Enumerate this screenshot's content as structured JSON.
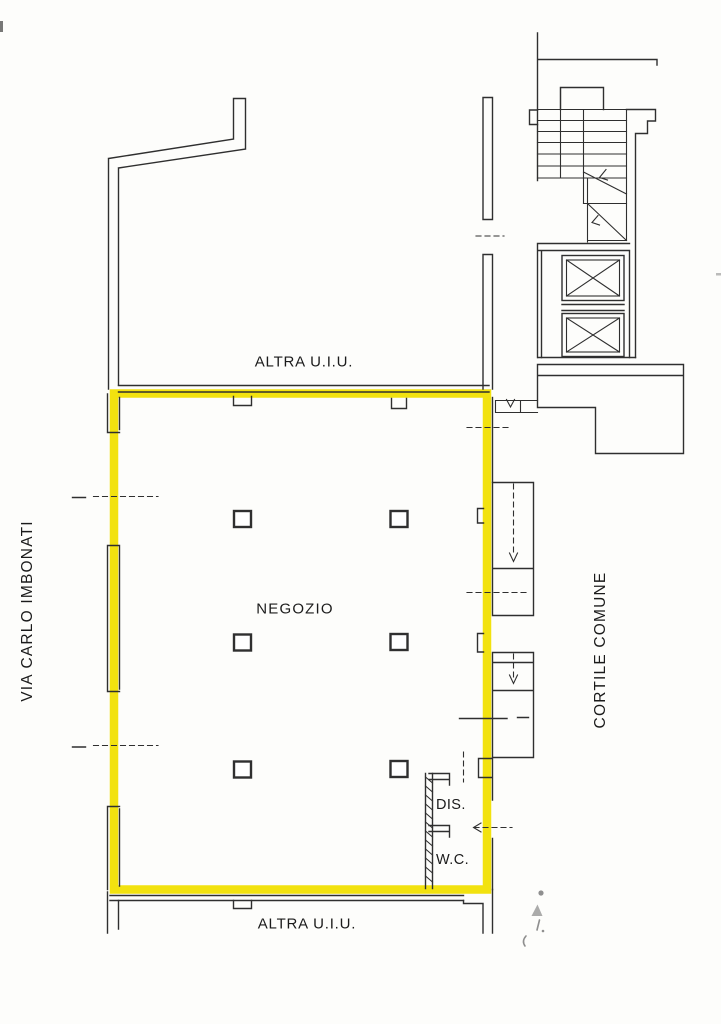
{
  "colors": {
    "highlight": "#F2E20F",
    "line": "#2f2f2f",
    "pencil": "#8f8f8f",
    "paper": "#fdfdfb"
  },
  "labels": {
    "street": "VIA CARLO IMBONATI",
    "courtyard": "CORTILE COMUNE",
    "shop": "NEGOZIO",
    "other_unit_top": "ALTRA U.I.U.",
    "other_unit_bottom": "ALTRA U.I.U.",
    "dis": "DIS.",
    "wc": "W.C."
  },
  "icons": {
    "stair_direction": "down-arrow",
    "door_swing": "left-arrow",
    "elevator_shaft": "x-cross-mark",
    "columns": "square-pillar"
  }
}
